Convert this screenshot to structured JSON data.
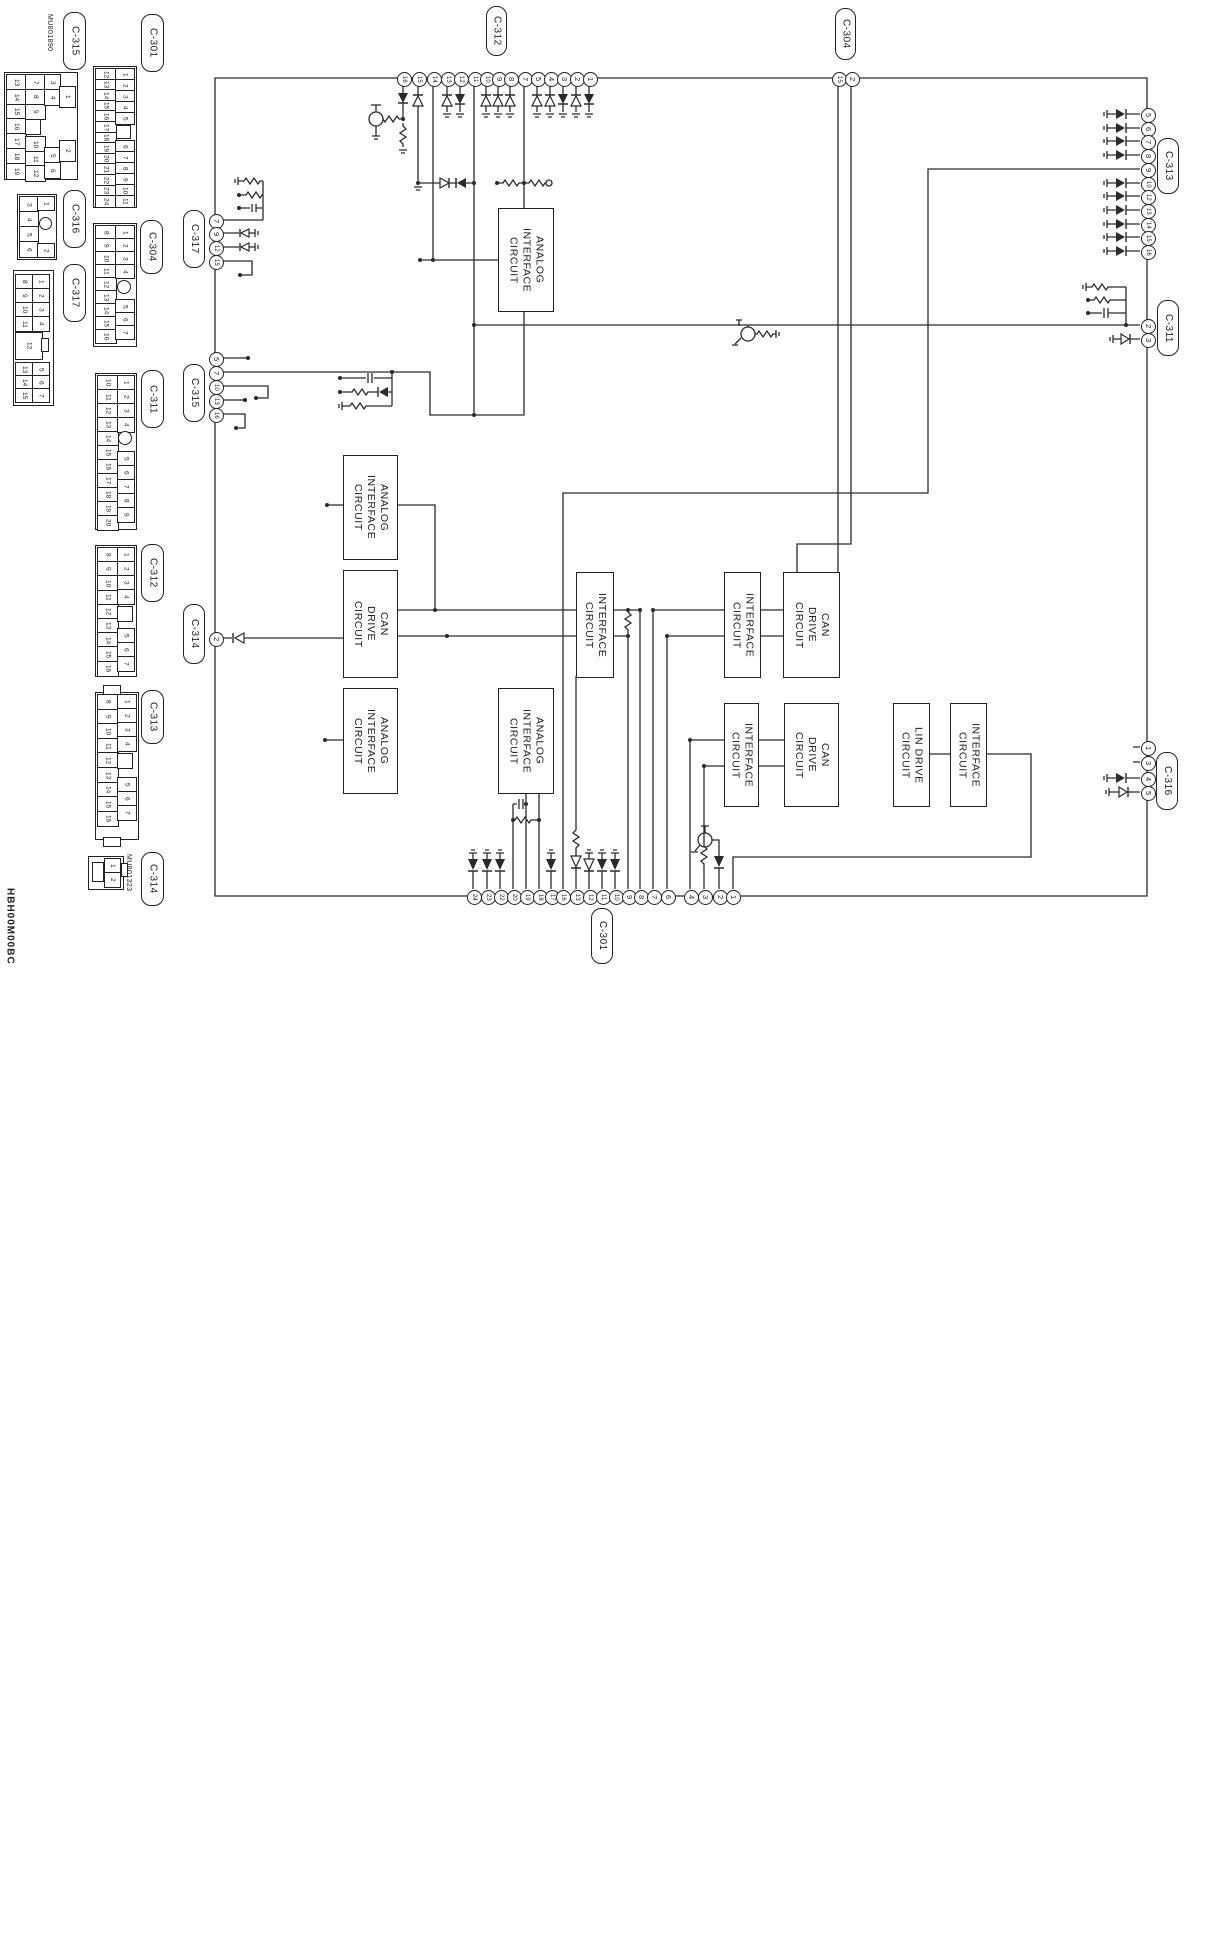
{
  "diagram_code": "HBH00M00BC",
  "colors": {
    "line": "#2b2b2b",
    "background": "#ffffff"
  },
  "circuit_boxes": [
    {
      "id": "analog-interface-top",
      "label": "ANALOG\nINTERFACE\nCIRCUIT"
    },
    {
      "id": "analog-interface-a1",
      "label": "ANALOG\nINTERFACE\nCIRCUIT"
    },
    {
      "id": "can-drive-a",
      "label": "CAN\nDRIVE\nCIRCUIT"
    },
    {
      "id": "analog-interface-a2",
      "label": "ANALOG\nINTERFACE\nCIRCUIT"
    },
    {
      "id": "analog-interface-b",
      "label": "ANALOG\nINTERFACE\nCIRCUIT"
    },
    {
      "id": "interface-c",
      "label": "INTERFACE\nCIRCUIT"
    },
    {
      "id": "interface-d1",
      "label": "INTERFACE\nCIRCUIT"
    },
    {
      "id": "can-drive-e1",
      "label": "CAN\nDRIVE\nCIRCUIT"
    },
    {
      "id": "interface-d2",
      "label": "INTERFACE\nCIRCUIT"
    },
    {
      "id": "can-drive-e2",
      "label": "CAN\nDRIVE\nCIRCUIT"
    },
    {
      "id": "lin-drive",
      "label": "LIN DRIVE\nCIRCUIT"
    },
    {
      "id": "interface-g",
      "label": "INTERFACE\nCIRCUIT"
    }
  ],
  "inline_connectors": [
    {
      "id": "C-312",
      "label": "C-312",
      "pins": [
        "16",
        "15",
        "14",
        "13",
        "12",
        "11",
        "10",
        "9",
        "8",
        "7",
        "5",
        "4",
        "3",
        "2",
        "1"
      ]
    },
    {
      "id": "C-304",
      "label": "C-304",
      "pins": [
        "15",
        "2"
      ]
    },
    {
      "id": "C-313",
      "label": "C-313",
      "pins": [
        "5",
        "6",
        "7",
        "8",
        "9",
        "10",
        "12",
        "13",
        "14",
        "15",
        "16"
      ]
    },
    {
      "id": "C-311",
      "label": "C-311",
      "pins": [
        "2",
        "3"
      ]
    },
    {
      "id": "C-316",
      "label": "C-316",
      "pins": [
        "1",
        "3",
        "4",
        "5"
      ]
    },
    {
      "id": "C-301",
      "label": "C-301",
      "pins": [
        "24",
        "23",
        "22",
        "20",
        "19",
        "18",
        "17",
        "16",
        "13",
        "12",
        "11",
        "10",
        "9",
        "8",
        "7",
        "6",
        "4",
        "3",
        "2",
        "1"
      ]
    },
    {
      "id": "C-317",
      "label": "C-317",
      "pins": [
        "7",
        "9",
        "12",
        "15"
      ]
    },
    {
      "id": "C-315",
      "label": "C-315",
      "pins": [
        "5",
        "7",
        "10",
        "13",
        "16"
      ]
    },
    {
      "id": "C-314",
      "label": "C-314",
      "pins": [
        "2"
      ]
    }
  ],
  "connector_faces": [
    {
      "id": "C-315",
      "label": "C-315",
      "part_no": "MU801890",
      "pins": [
        "13",
        "14",
        "15",
        "16",
        "17",
        "18",
        "19",
        "7",
        "8",
        "9",
        "10",
        "11",
        "12",
        "3",
        "4",
        "5",
        "6",
        "1",
        "2"
      ]
    },
    {
      "id": "C-301",
      "label": "C-301",
      "pins": [
        "12",
        "13",
        "14",
        "15",
        "16",
        "17",
        "18",
        "19",
        "20",
        "21",
        "22",
        "23",
        "24",
        "1",
        "2",
        "3",
        "4",
        "5",
        "6",
        "7",
        "8",
        "9",
        "10",
        "11"
      ]
    },
    {
      "id": "C-316",
      "label": "C-316",
      "pins": [
        "3",
        "4",
        "5",
        "6",
        "1",
        "2"
      ]
    },
    {
      "id": "C-304",
      "label": "C-304",
      "pins": [
        "8",
        "9",
        "10",
        "11",
        "12",
        "13",
        "14",
        "15",
        "16",
        "1",
        "2",
        "3",
        "4",
        "5",
        "6",
        "7"
      ]
    },
    {
      "id": "C-317",
      "label": "C-317",
      "pins": [
        "8",
        "9",
        "10",
        "11",
        "1",
        "2",
        "3",
        "4",
        "12",
        "13",
        "14",
        "15",
        "5",
        "6",
        "7"
      ]
    },
    {
      "id": "C-311",
      "label": "C-311",
      "pins": [
        "10",
        "11",
        "12",
        "13",
        "14",
        "15",
        "16",
        "17",
        "18",
        "19",
        "20",
        "1",
        "2",
        "3",
        "4",
        "5",
        "6",
        "7",
        "8",
        "9"
      ]
    },
    {
      "id": "C-312",
      "label": "C-312",
      "pins": [
        "8",
        "9",
        "10",
        "11",
        "12",
        "13",
        "14",
        "15",
        "16",
        "1",
        "2",
        "3",
        "4",
        "5",
        "6",
        "7"
      ]
    },
    {
      "id": "C-313",
      "label": "C-313",
      "pins": [
        "8",
        "9",
        "10",
        "11",
        "12",
        "13",
        "14",
        "15",
        "16",
        "1",
        "2",
        "3",
        "4",
        "5",
        "6",
        "7"
      ]
    },
    {
      "id": "C-314",
      "label": "C-314",
      "part_no": "MU801323",
      "pins": [
        "1",
        "2"
      ]
    }
  ]
}
